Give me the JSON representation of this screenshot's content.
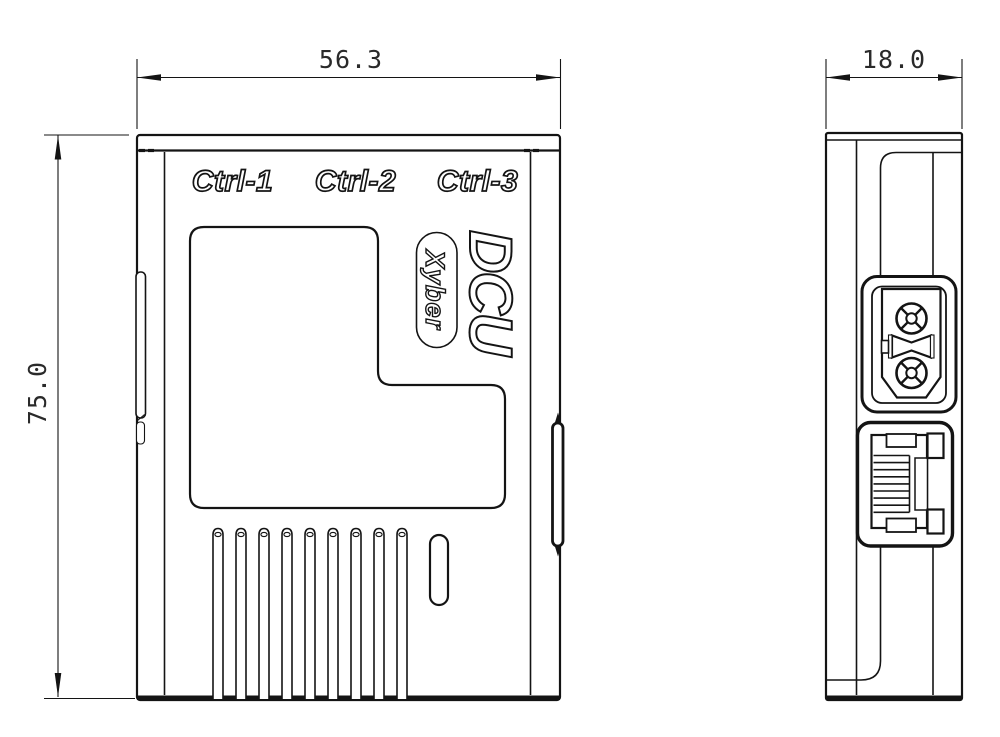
{
  "front_view": {
    "port_labels": [
      "Ctrl-1",
      "Ctrl-2",
      "Ctrl-3"
    ],
    "product_name": "DCU",
    "brand": "Xyber",
    "dimensions": {
      "width_mm": "56.3",
      "height_mm": "75.0"
    }
  },
  "side_view": {
    "dimensions": {
      "depth_mm": "18.0"
    },
    "connector_icons": [
      "xt30-power-connector-icon",
      "rj45-ethernet-port-icon"
    ]
  },
  "colors": {
    "line": "#141414",
    "background": "#ffffff"
  }
}
